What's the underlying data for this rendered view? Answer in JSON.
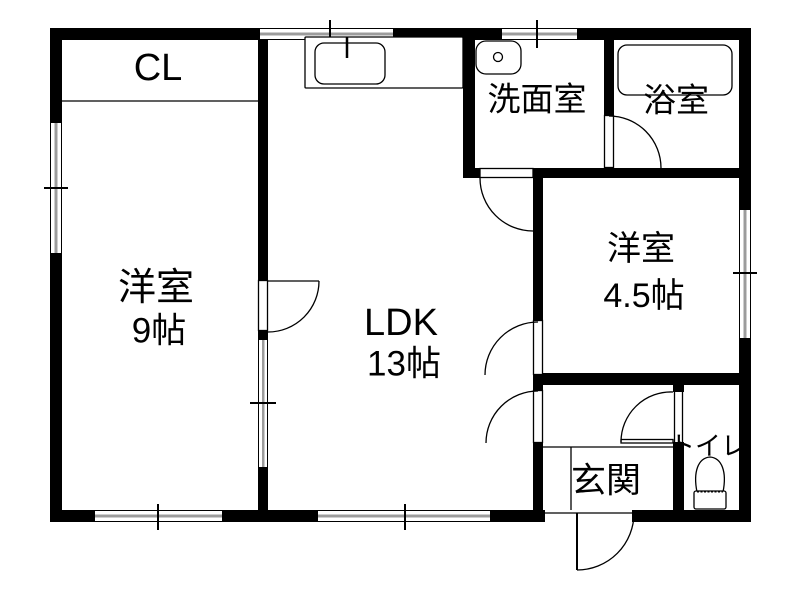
{
  "plan": {
    "type": "floor-plan",
    "colors": {
      "wall": "#000000",
      "background": "#ffffff",
      "window_fill": "#9c9c9c",
      "line": "#000000"
    },
    "rooms": {
      "closet": {
        "label": "CL"
      },
      "bedroom9": {
        "label": "洋室",
        "size": "9帖"
      },
      "ldk": {
        "label": "LDK",
        "size": "13帖"
      },
      "washroom": {
        "label": "洗面室"
      },
      "bathroom": {
        "label": "浴室"
      },
      "bedroom45": {
        "label": "洋室",
        "size": "4.5帖"
      },
      "entrance": {
        "label": "玄関"
      },
      "toilet": {
        "label": "トイレ"
      }
    },
    "fixtures": [
      "kitchen-sink-icon",
      "washbasin-icon",
      "bathtub-icon",
      "toilet-icon"
    ]
  }
}
